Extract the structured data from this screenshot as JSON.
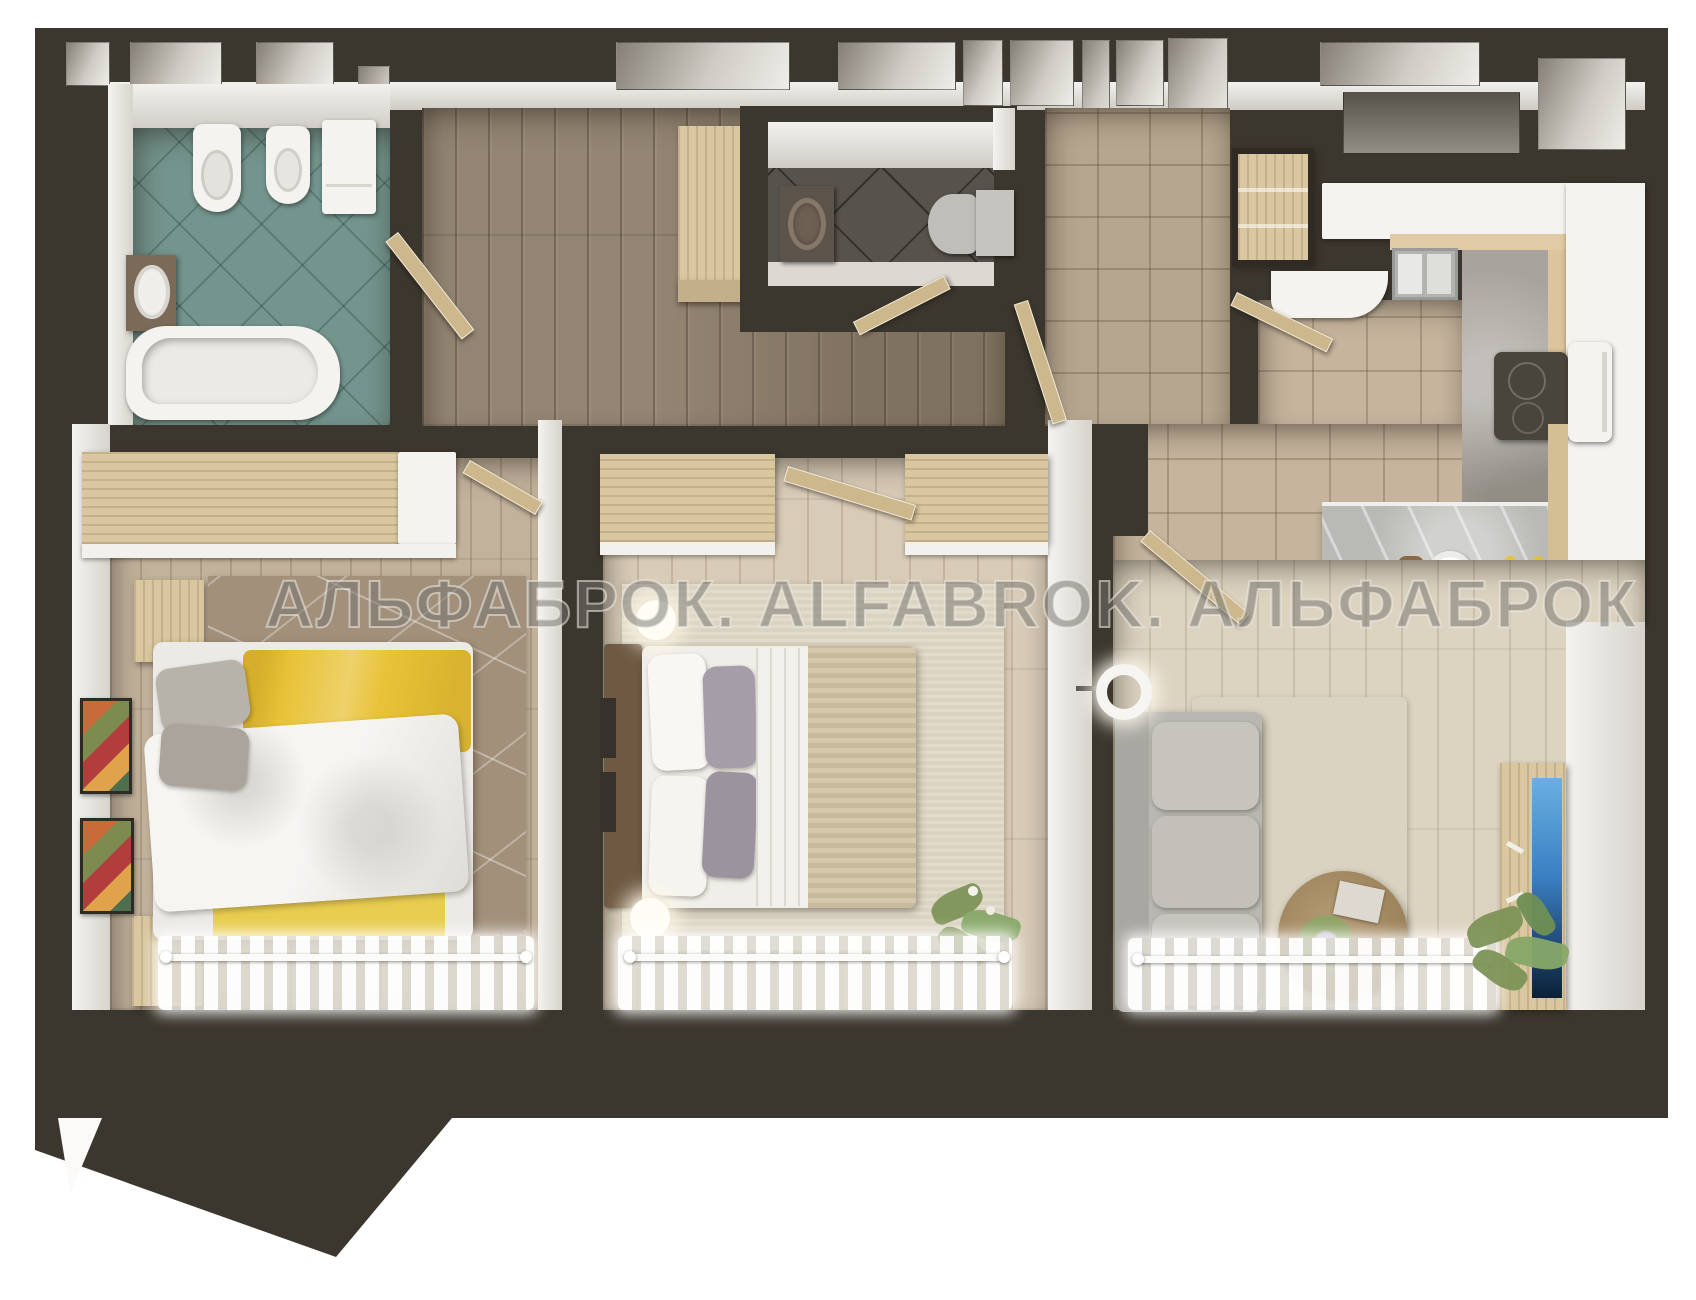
{
  "title": "apartment-3d-floor-plan-render",
  "watermark": {
    "text": "АЛЬФАБРОК. ALFABROK. АЛЬФАБРОК"
  },
  "palette": {
    "background": "#ffffff",
    "wall": "#3b362e",
    "bathroom_tile": "#74958e",
    "hall_wood": "#8b7c68",
    "wc_floor": "#57524b",
    "entry_tile": "#b7a68f",
    "kitchen_tile": "#c6b49d",
    "bed1_wood": "#c2b29c",
    "bed2_wood": "#d8cbb7",
    "living_wood": "#ddd3c1",
    "furniture_wood": "#d9c7a0",
    "door_wood": "#cdb88d",
    "accent_yellow": "#e8c237",
    "sofa_gray": "#b9b7b1",
    "concrete": "#a8a49d",
    "tv_blue": "#3a7fc2",
    "rug_taupe": "#a2907b",
    "rug_cream": "#dbd3c1",
    "fixture_white": "#f4f3f0",
    "plant_green": "#7d9457"
  },
  "rooms": [
    {
      "name": "bathroom",
      "furniture": [
        "toilet",
        "bidet",
        "washing-machine",
        "vanity-sink",
        "bathtub"
      ]
    },
    {
      "name": "hallway",
      "furniture": [
        "wardrobe",
        "doors"
      ]
    },
    {
      "name": "wc",
      "furniture": [
        "vanity-sink",
        "toilet"
      ]
    },
    {
      "name": "entry-hall",
      "furniture": [
        "built-in-closets"
      ]
    },
    {
      "name": "kitchen",
      "furniture": [
        "counter-with-sink",
        "cooktop",
        "oven",
        "bar-counter",
        "bar-stools",
        "plate",
        "lemons"
      ]
    },
    {
      "name": "bedroom-1",
      "furniture": [
        "wardrobe",
        "double-bed-yellow",
        "nightstands",
        "rug",
        "wall-art",
        "radiator-curtains"
      ]
    },
    {
      "name": "bedroom-2",
      "furniture": [
        "wardrobe",
        "double-bed-beige",
        "wall-lamps",
        "rug",
        "plant",
        "radiator-curtains"
      ]
    },
    {
      "name": "living-room",
      "furniture": [
        "sofa",
        "floor-lamp",
        "round-coffee-table",
        "tv-console",
        "plant",
        "radiator-curtains"
      ]
    }
  ]
}
